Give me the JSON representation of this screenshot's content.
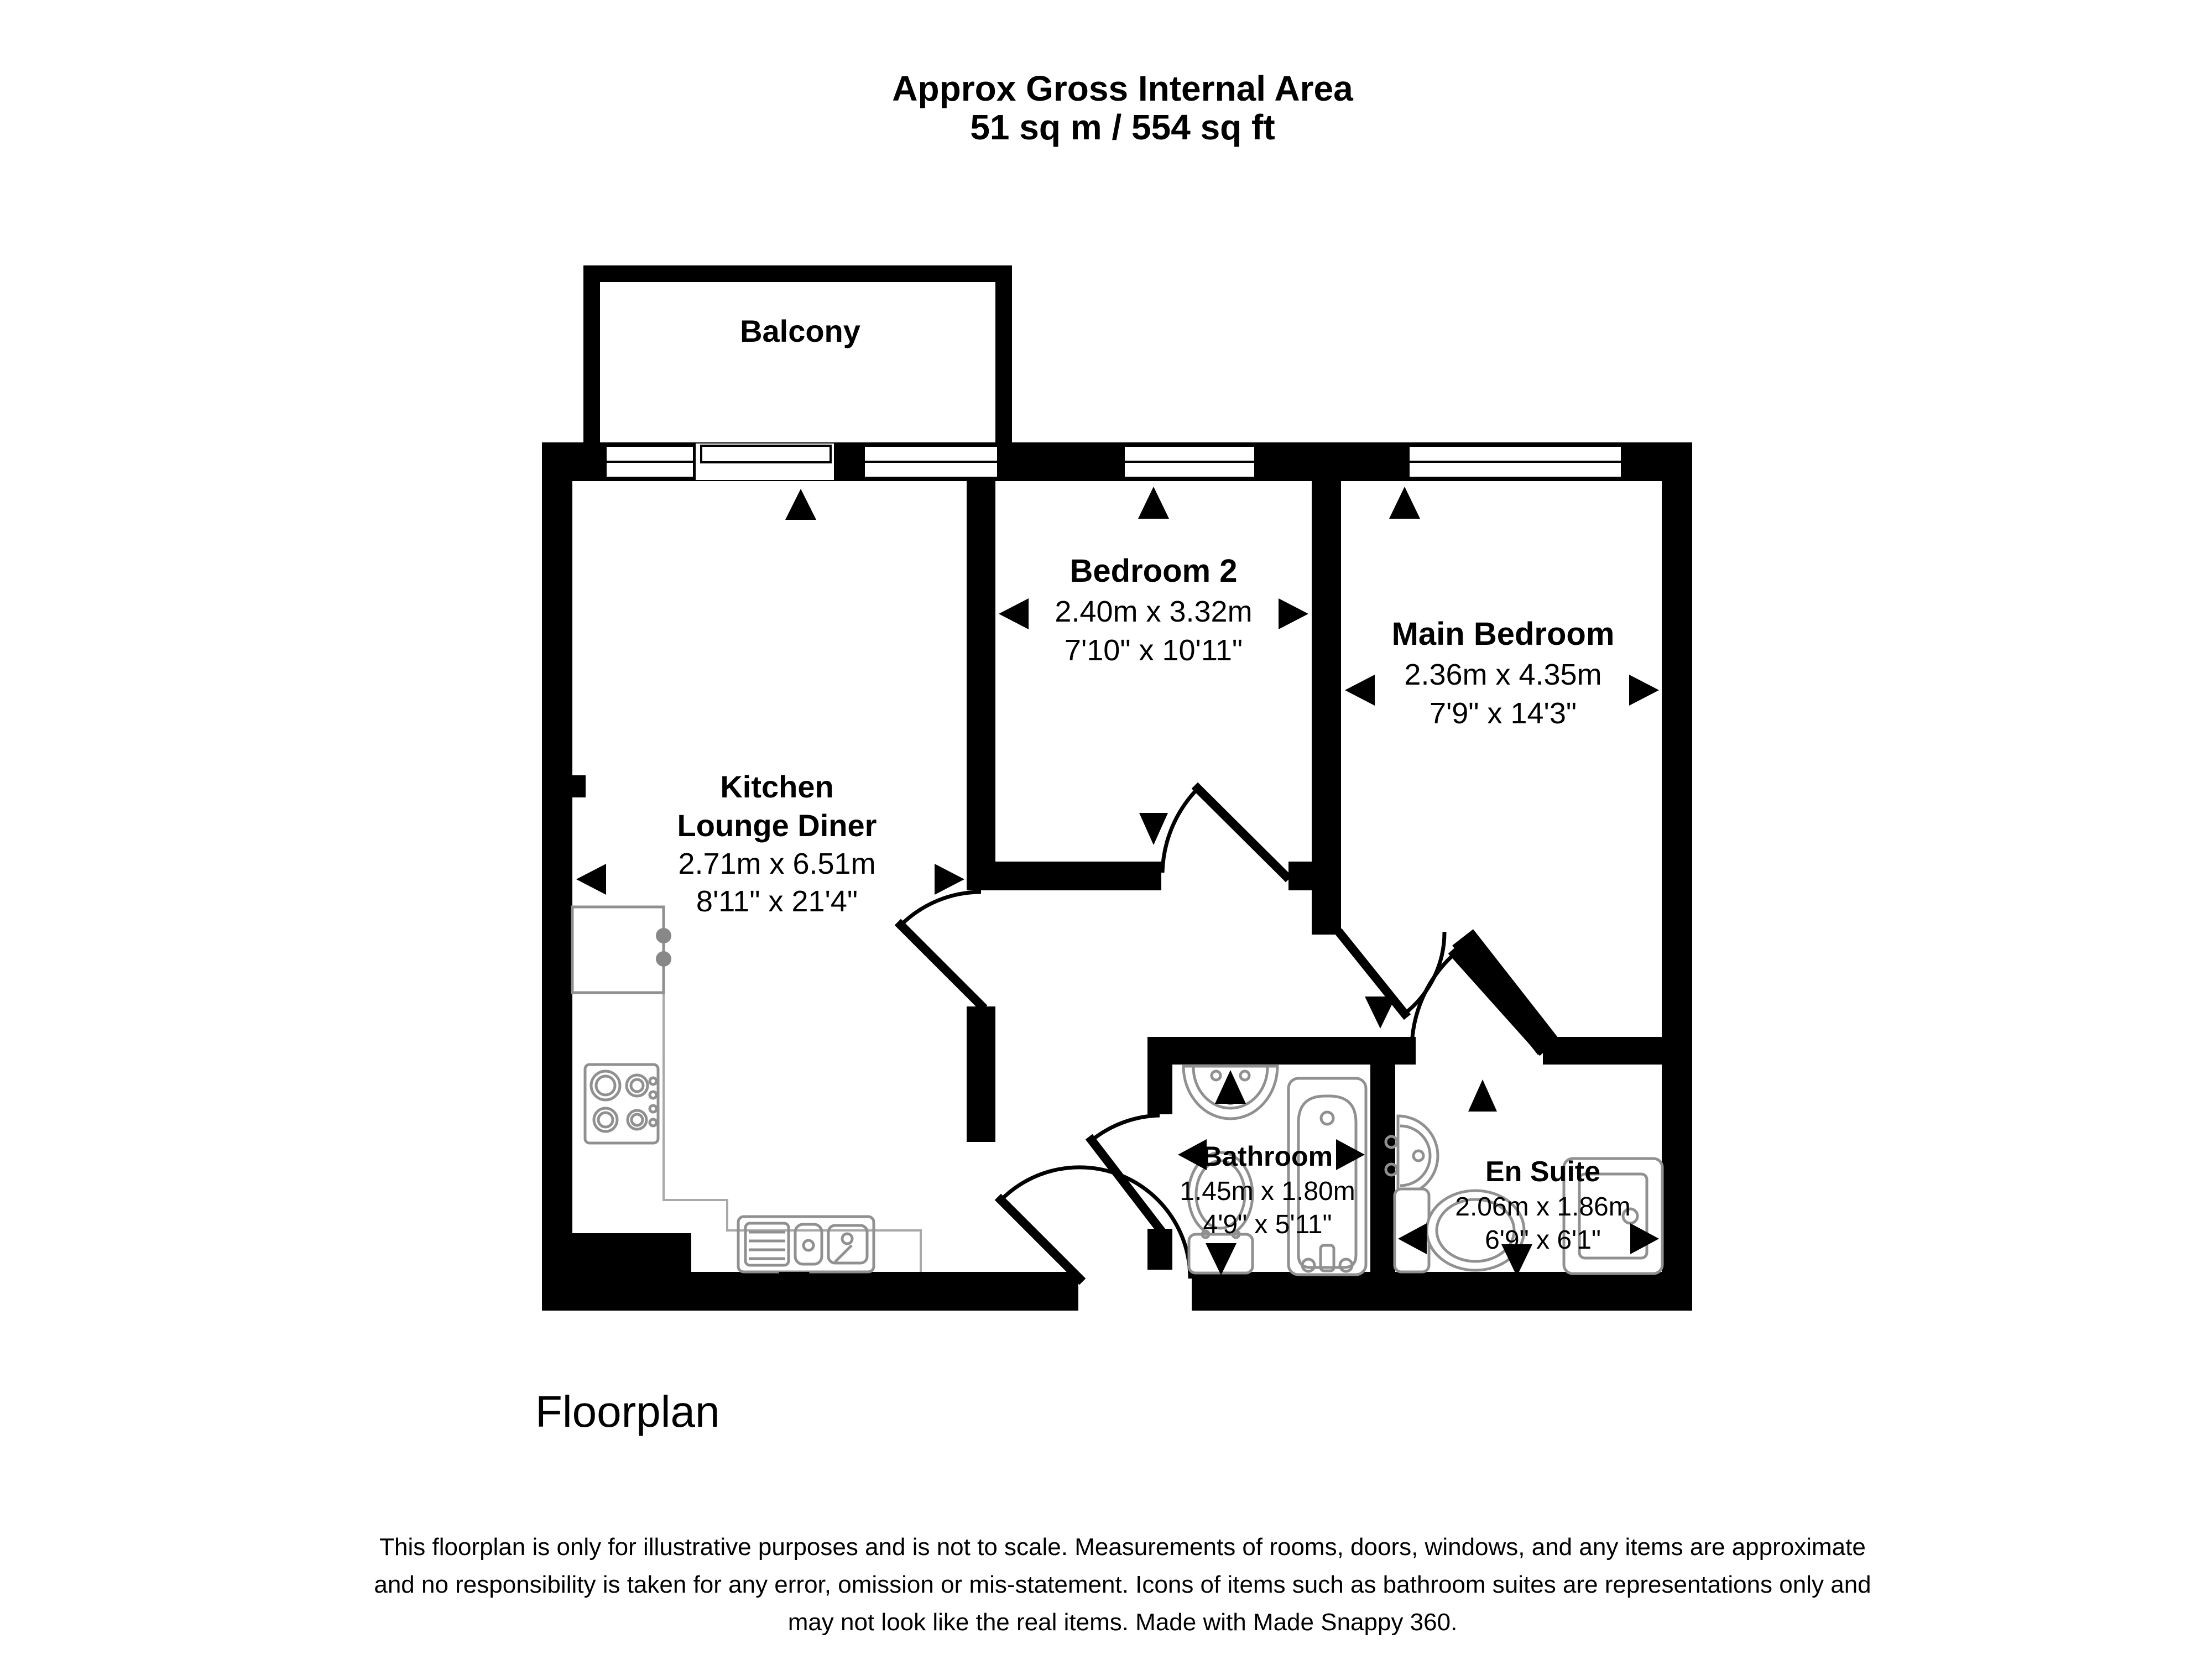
{
  "header": {
    "title_line1": "Approx Gross Internal Area",
    "title_line2": "51 sq m / 554 sq ft"
  },
  "rooms": {
    "balcony": {
      "name": "Balcony"
    },
    "kitchen_lounge_diner": {
      "name_line1": "Kitchen",
      "name_line2": "Lounge Diner",
      "metric": "2.71m x 6.51m",
      "imperial": "8'11\" x 21'4\""
    },
    "bedroom2": {
      "name": "Bedroom 2",
      "metric": "2.40m x 3.32m",
      "imperial": "7'10\" x 10'11\""
    },
    "main_bedroom": {
      "name": "Main Bedroom",
      "metric": "2.36m x 4.35m",
      "imperial": "7'9\" x 14'3\""
    },
    "bathroom": {
      "name": "Bathroom",
      "metric": "1.45m x 1.80m",
      "imperial": "4'9\" x 5'11\""
    },
    "en_suite": {
      "name": "En Suite",
      "metric": "2.06m x 1.86m",
      "imperial": "6'9\" x 6'1\""
    }
  },
  "footer": {
    "caption": "Floorplan",
    "disclaimer_line1": "This floorplan is only for illustrative purposes and is not to scale. Measurements of rooms, doors, windows, and any items are approximate",
    "disclaimer_line2": "and no responsibility is taken for any error, omission or mis-statement. Icons of items such as bathroom suites are representations only and",
    "disclaimer_line3": "may not look like the real items. Made with Made Snappy 360."
  },
  "colors": {
    "wall": "#000000",
    "fixture_outline": "#909090",
    "counter_outline": "#a8a8a8",
    "background": "#ffffff"
  }
}
